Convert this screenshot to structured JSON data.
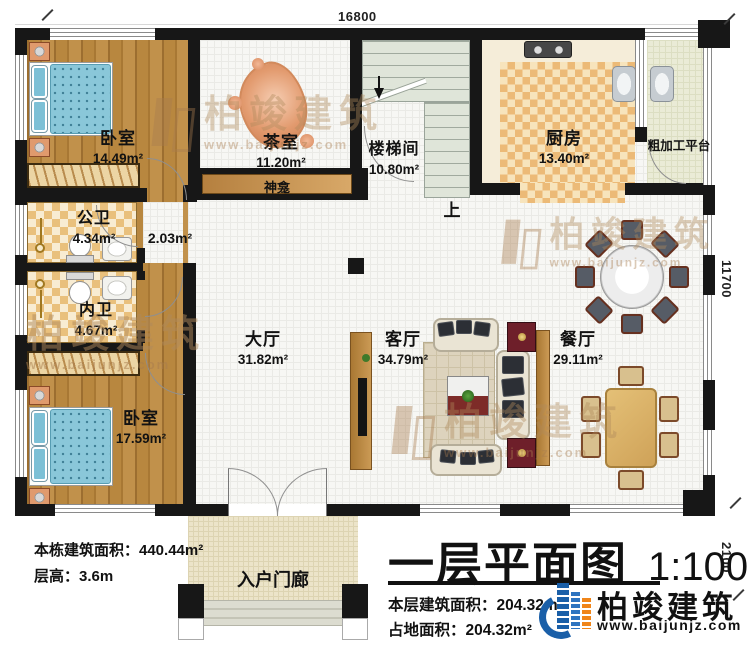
{
  "plan": {
    "dimensions": {
      "top": "16800",
      "right": "11700",
      "bottom_right": "2100"
    },
    "rooms": {
      "bedroom_top": {
        "name": "卧室",
        "area": "14.49m²"
      },
      "tea_room": {
        "name": "茶室",
        "area": "11.20m²"
      },
      "stairwell": {
        "name": "楼梯间",
        "area": "10.80m²"
      },
      "kitchen": {
        "name": "厨房",
        "area": "13.40m²"
      },
      "prep_platform": {
        "name": "粗加工平台"
      },
      "shrine": {
        "name": "神龛"
      },
      "public_bath": {
        "name": "公卫",
        "area": "4.34m²"
      },
      "corridor": {
        "area": "2.03m²"
      },
      "private_bath": {
        "name": "内卫",
        "area": "4.67m²"
      },
      "bedroom_bottom": {
        "name": "卧室",
        "area": "17.59m²"
      },
      "hall": {
        "name": "大厅",
        "area": "31.82m²"
      },
      "living_room": {
        "name": "客厅",
        "area": "34.79m²"
      },
      "dining_room": {
        "name": "餐厅",
        "area": "29.11m²"
      },
      "entrance_porch": {
        "name": "入户门廊"
      }
    },
    "stairs": {
      "up_label": "上"
    }
  },
  "info_left": {
    "building_area": "本栋建筑面积：440.44m²",
    "floor_height": "层高：3.6m"
  },
  "title_block": {
    "title": "一层平面图",
    "scale": "1:100",
    "floor_area": "本层建筑面积：204.32m²",
    "footprint_area": "占地面积：204.32m²"
  },
  "brand": {
    "name": "柏竣建筑",
    "website": "www.baijunjz.com"
  },
  "watermark": {
    "name": "柏竣建筑",
    "website": "www.baijunjz.com"
  },
  "colors": {
    "wall": "#171717",
    "wood_floor": "#b8873f",
    "tile_checker": "#e9c07c",
    "brand_blue": "#1a5fa8",
    "brand_orange": "#f08519",
    "cabinet_red": "#6e1f2a",
    "bed_blue": "#7cc0d6"
  }
}
